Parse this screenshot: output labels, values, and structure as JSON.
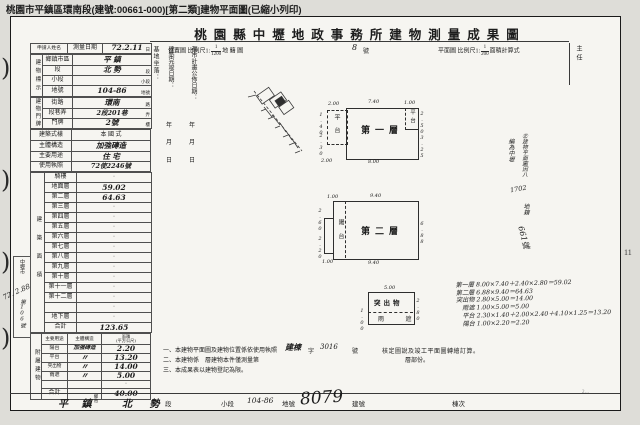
{
  "page": {
    "top_bar": "桃園市平鎮區環南段(建號:00661-000)[第二類]建物平面圖(已縮小列印)",
    "page_number": "11",
    "corner_mark": "2…",
    "margin_hand_date": "72. 2.88",
    "receipt_box": {
      "top": "中壢市",
      "bottom": "第106號"
    }
  },
  "title": "桃園縣中壢地政事務所建物測量成果圖",
  "header": {
    "loc": "位置圖 比例尺1:",
    "frac1": {
      "num": "1",
      "den": "1200"
    },
    "loc2": "地 籍 圖",
    "sheet_no": "8",
    "sheet_no_unit": "號",
    "plan": "平面圖 比例尺1:",
    "frac2": {
      "num": "1",
      "den": "200"
    },
    "plan2": "面積計算式"
  },
  "left": {
    "applicant": "申請人姓名",
    "survey": {
      "label": "測量日期",
      "value": "72.2.11",
      "unit": "日"
    },
    "mark": {
      "group": "建物標示",
      "rows": [
        {
          "label": "鄉鎮市區",
          "value": "平 鎮",
          "unit": ""
        },
        {
          "label": "段",
          "value": "北 勢",
          "unit": "段"
        },
        {
          "label": "小段",
          "value": "",
          "unit": "小段"
        },
        {
          "label": "地號",
          "value": "104-86",
          "unit": "地號"
        }
      ]
    },
    "plate": {
      "group": "建物門牌",
      "rows": [
        {
          "label": "街路",
          "value": "環南",
          "unit": "路"
        },
        {
          "label": "段巷弄",
          "value": "2段201巷",
          "unit": "弄"
        },
        {
          "label": "門牌",
          "value": "2號",
          "unit": "樓"
        }
      ]
    },
    "style": {
      "label": "建築式樣",
      "value": "本 國 式"
    },
    "structure": {
      "label": "主體構造",
      "value": "加強磚造"
    },
    "usage": {
      "label": "主要用途",
      "value": "住 宅"
    },
    "license": {
      "label": "使用執照",
      "value": "72使2246號"
    },
    "floors": {
      "group": "建築面積",
      "rows": [
        {
          "label": "騎樓",
          "value": "·"
        },
        {
          "label": "地面層",
          "value": "59.02"
        },
        {
          "label": "第二層",
          "value": "64.63"
        },
        {
          "label": "第三層",
          "value": "·"
        },
        {
          "label": "第四層",
          "value": "·"
        },
        {
          "label": "第五層",
          "value": "·"
        },
        {
          "label": "第六層",
          "value": "·"
        },
        {
          "label": "第七層",
          "value": "·"
        },
        {
          "label": "第八層",
          "value": "·"
        },
        {
          "label": "第九層",
          "value": "·"
        },
        {
          "label": "第十層",
          "value": "·"
        },
        {
          "label": "第十一層",
          "value": "·"
        },
        {
          "label": "第十二層",
          "value": "·"
        },
        {
          "label": "",
          "value": "·"
        },
        {
          "label": "地下層",
          "value": "·"
        }
      ],
      "total_label": "合計",
      "total": "123.65"
    },
    "attached": {
      "group": "附屬建物",
      "cols": {
        "usage": "主要用途",
        "structure": "主體構造",
        "area": "面積",
        "area2": "(平方公尺)"
      },
      "rows": [
        {
          "usage": "陽台",
          "structure": "加強磚造",
          "area": "2.20"
        },
        {
          "usage": "平台",
          "structure": "〃",
          "area": "13.20"
        },
        {
          "usage": "突出物",
          "structure": "〃",
          "area": "14.00"
        },
        {
          "usage": "雨遮",
          "structure": "〃",
          "area": "5.00"
        },
        {
          "usage": "",
          "structure": "",
          "area": "·"
        }
      ],
      "total_label": "合計",
      "total": "40.00"
    }
  },
  "middle": {
    "site": "基地坐落：",
    "completion": "建築完竣日期：",
    "publish": "都市計畫公佈日期：",
    "y": "年",
    "m": "月",
    "d": "日",
    "chief": "主任"
  },
  "plans": {
    "first": {
      "label": "第一層",
      "annexL": "平台",
      "annexR": "平台",
      "dims": {
        "tl": "2.00",
        "t": "7.40",
        "tr": "1.00",
        "rt": "2.50",
        "rb": "3.25",
        "lt": "1.40",
        "lb": "2.30",
        "b": "8.00",
        "bl": "2.00"
      }
    },
    "second": {
      "label": "第二層",
      "annex": "陽台",
      "dims": {
        "tl": "1.00",
        "t": "9.40",
        "lt": "2.60",
        "lb": "2.20",
        "r": "6.88",
        "b": "9.40",
        "bl": "1.00"
      }
    },
    "prot": {
      "label": "突出物",
      "sub": "雨 遮",
      "dims": {
        "t": "5.00",
        "r": "2.80",
        "l": "1.00"
      }
    }
  },
  "calc": {
    "lines": [
      "第一層 8.00×7.40＋2.40×2.80＝59.02",
      "第二層 6.88×9.40＝64.63",
      "突出物 2.80×5.00＝14.00",
      "雨遮 1.00×5.00＝5.00",
      "平台 2.30×1.40＋2.00×2.40＋4.10×1.25＝13.20",
      "陽台 1.00×2.20＝2.20"
    ]
  },
  "sidenote": {
    "col1": "㊣建物平面圖因八",
    "col2": "編為中壢",
    "num": "1702",
    "col3": "地籍",
    "tail": "661號"
  },
  "notes": {
    "n1": "一、本建物平面圖及建物位置係依使用執照",
    "n1_hand1": "建棟",
    "n1_mid": "字",
    "n1_hand2": "3016",
    "n1_no": "號",
    "n1_tail": "核定圖說及竣工平面圖轉繪訂算。",
    "n2a": "二、本建物係　層建物本件僅測量第",
    "n2b": "層部份。",
    "n3": "三、本成果表以建物登記為限。"
  },
  "footer": {
    "city": "平 鎮",
    "city_unit": "鄉市",
    "section": "北 勢",
    "section_unit": "段",
    "subsection": "小段",
    "parcel": "104-86",
    "parcel_unit": "地號",
    "bno": "8079",
    "bno_unit": "建號",
    "unit": "棟次"
  }
}
